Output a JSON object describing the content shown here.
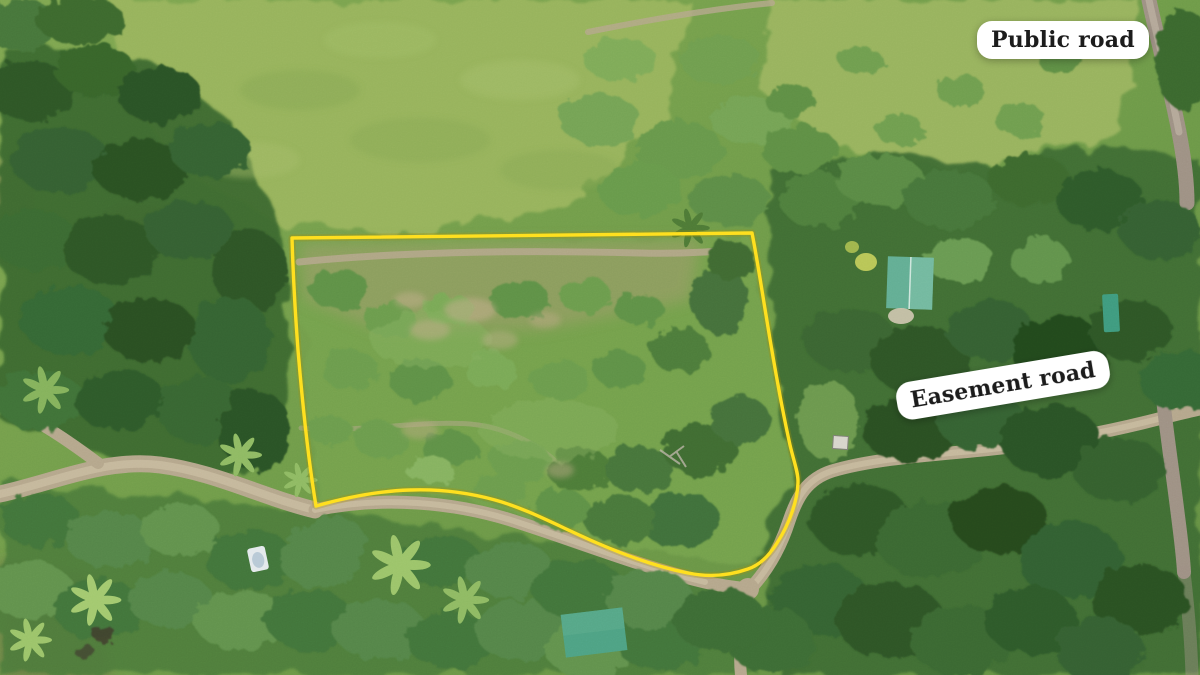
{
  "annotations": {
    "public_road_label": "Public road",
    "easement_road_label": "Easement road"
  },
  "boundary": {
    "description": "parcel-outline",
    "path_d": "M292 238 L752 233 C757 258 761 285 766 315 C772 352 780 400 790 445 C794 462 798 472 798 481 C798 499 790 523 777 543 C769 556 760 565 748 569 C728 576 707 577 688 573 C658 567 627 556 597 543 C562 528 528 509 495 500 C466 492 437 489 410 490 C377 491 344 498 316 506 C309 464 303 410 298 350 C295 310 293 272 292 238 Z"
  },
  "colors": {
    "boundary-yellow": "#ffdf1e",
    "label-bg": "#ffffff",
    "label-text": "#1c1c1c",
    "roof-teal": "#63ae94",
    "roof-teal-dark": "#3f9b7f",
    "roof-green": "#4ea284",
    "road-tan": "#b5a78c",
    "road-gray": "#9e9184"
  }
}
